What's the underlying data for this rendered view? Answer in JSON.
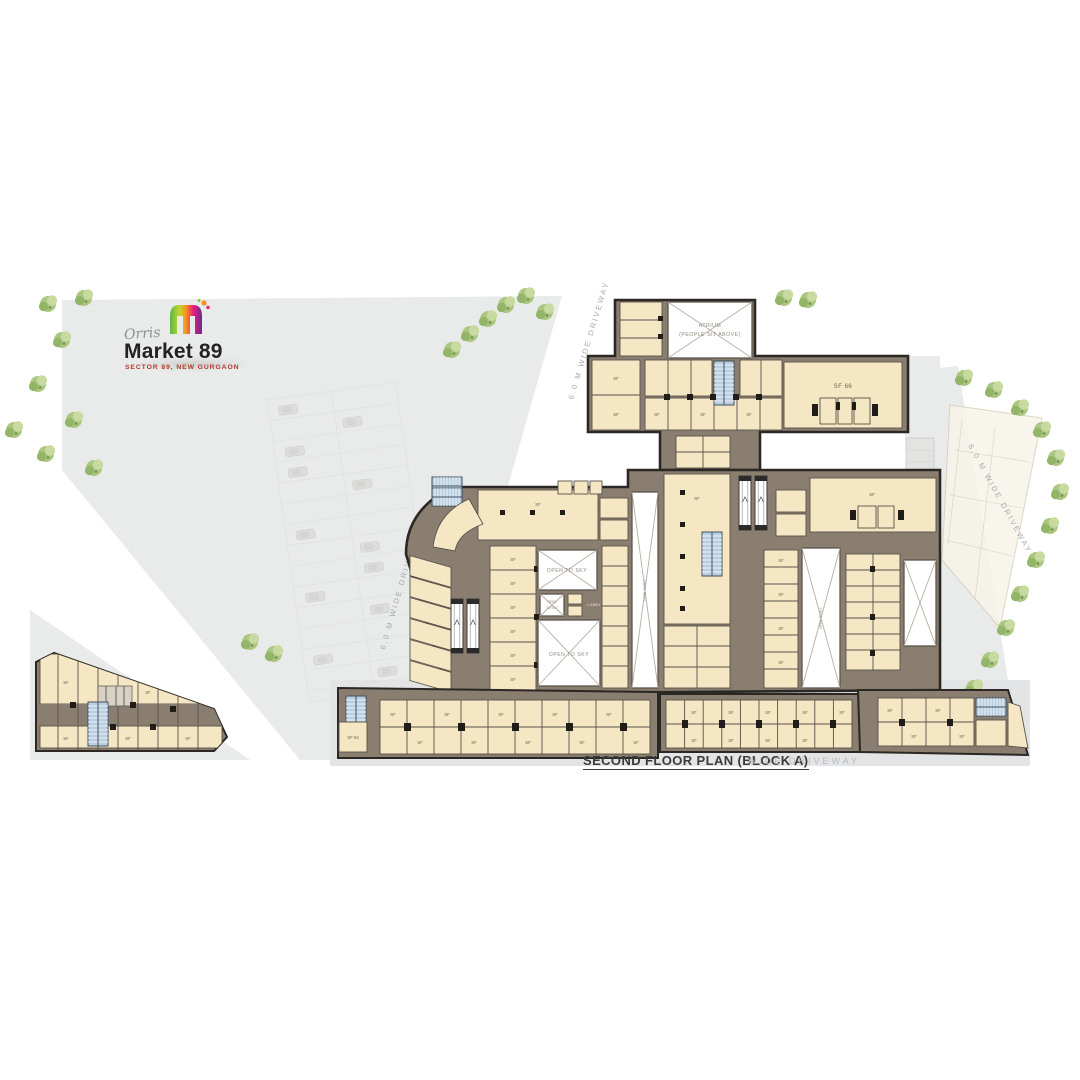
{
  "logo": {
    "brand": "Orris",
    "name": "Market 89",
    "subtitle": "SECTOR 89, NEW GURGAON"
  },
  "plan": {
    "title": "SECOND FLOOR PLAN (BLOCK A)",
    "labels": {
      "open_to_sky": "OPEN TO SKY",
      "open": "OPEN",
      "to_sky": "TO SKY",
      "atrium": "ATRIUM",
      "atrium_sub": "(PEOPLE SIT ABOVE)",
      "driveway": "6.0 M WIDE DRIVEWAY",
      "driveway_faint": "WIDE DRIVEWAY",
      "lobby": "LOBBY",
      "lift": "LIFT",
      "sf": "SF",
      "sf66": "SF 66",
      "sf84": "SF 84"
    },
    "colors": {
      "unit_fill": "#f5e7c4",
      "corridor": "#8a7e71",
      "wall": "#2b2723",
      "stairs": "#b9cfe0",
      "open_to_sky": "#ffffff",
      "greenery": "#abc77f",
      "ground": "#e9eaea",
      "logo_accent": "#b03a2e"
    }
  }
}
